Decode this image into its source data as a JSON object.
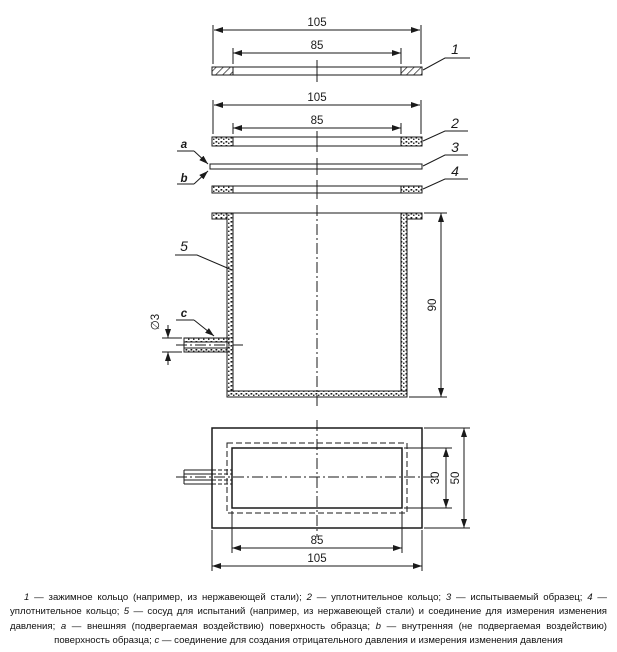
{
  "figure": {
    "parts": {
      "p1": "1",
      "p2": "2",
      "p3": "3",
      "p4": "4",
      "p5": "5",
      "a": "a",
      "b": "b",
      "c": "c"
    },
    "dims": {
      "ring1_outer": "105",
      "ring1_inner": "85",
      "group2_outer": "105",
      "group2_inner": "85",
      "vessel_height": "90",
      "pipe_diameter": "∅3",
      "plan_inner_height": "30",
      "plan_outer_height": "50",
      "plan_inner_width": "85",
      "plan_outer_width": "105"
    }
  },
  "caption": {
    "segments": [
      {
        "t": "1",
        "i": 1
      },
      {
        "t": " — зажимное кольцо (например, из нержавеющей стали); ",
        "i": 0
      },
      {
        "t": "2",
        "i": 1
      },
      {
        "t": " — уплотнительное кольцо; ",
        "i": 0
      },
      {
        "t": "3",
        "i": 1
      },
      {
        "t": " — испытываемый образец; ",
        "i": 0
      },
      {
        "t": "4",
        "i": 1
      },
      {
        "t": " — уплотнительное кольцо; ",
        "i": 0
      },
      {
        "t": "5",
        "i": 1
      },
      {
        "t": " — сосуд для испытаний (например, из нержавеющей стали) и соединение для измерения изменения давления; ",
        "i": 0
      },
      {
        "t": "a",
        "i": 1
      },
      {
        "t": " — внешняя (подвергаемая воздействию) поверхность образца; ",
        "i": 0
      },
      {
        "t": "b",
        "i": 1
      },
      {
        "t": " — внутренняя (не подвергаемая воздействию) поверхность образца; ",
        "i": 0
      },
      {
        "t": "c",
        "i": 1
      },
      {
        "t": " — соединение для создания отрицательного давления и измерения изменения давления",
        "i": 0
      }
    ]
  }
}
